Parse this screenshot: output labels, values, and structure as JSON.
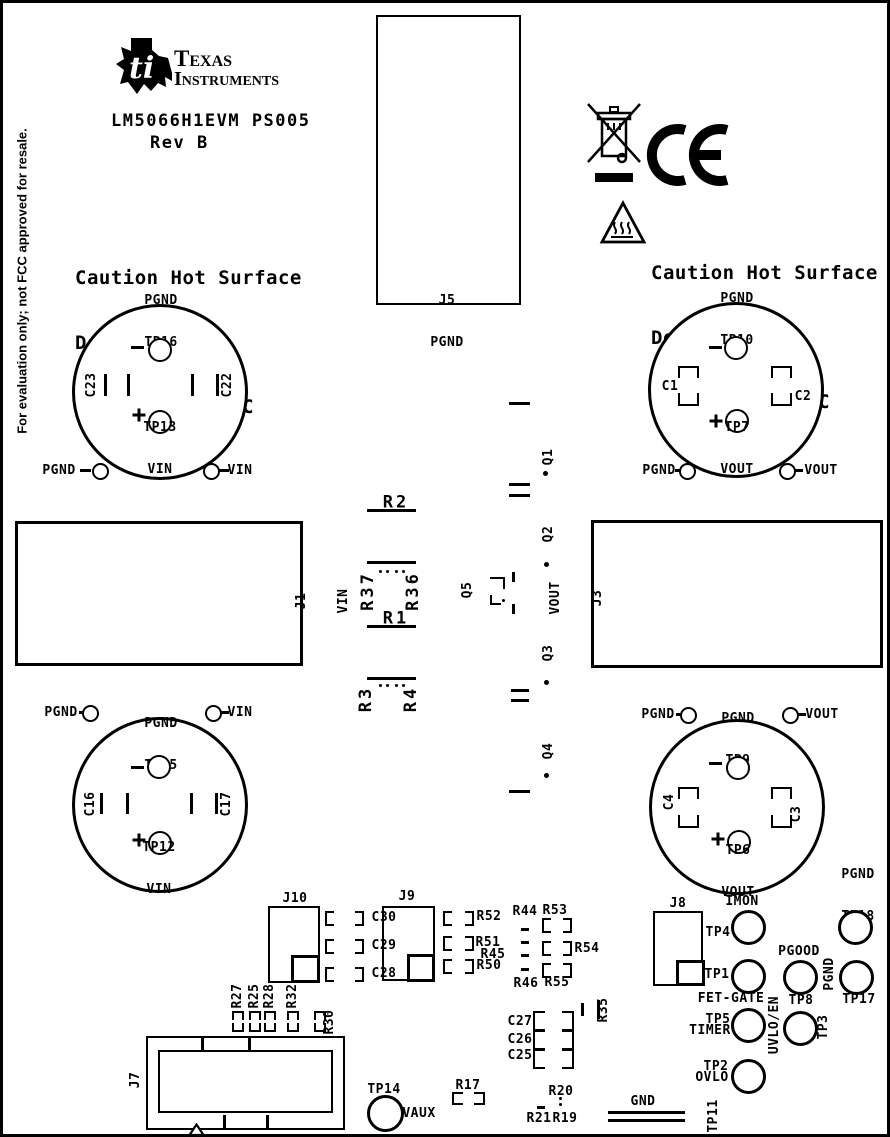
{
  "board": {
    "side_note": "For evaluation only; not FCC approved for resale.",
    "brand": {
      "line1": "Texas",
      "line2": "Instruments",
      "monogram": "ti"
    },
    "title": "LM5066H1EVM PS005",
    "revision": "Rev B",
    "caution": {
      "line1": "Caution Hot Surface",
      "line2": "Do not touch!",
      "line3": "100A Maximum DC"
    },
    "icons": {
      "ti_logo": "texas-instruments-logo",
      "weee": "weee-crossed-out-bin",
      "ce": "ce-marking",
      "hot_surface": "hot-surface-warning-triangle",
      "pin1": "pin1-marker-triangle"
    }
  },
  "connectors": {
    "j1": {
      "ref": "J1",
      "net": "VIN"
    },
    "j3": {
      "net": "VOUT",
      "ref": "J3"
    },
    "j5": {
      "ref": "J5",
      "net": "PGND"
    },
    "j7": {
      "ref": "J7"
    },
    "j8": {
      "ref": "J8"
    },
    "j9": {
      "ref": "J9"
    },
    "j10": {
      "ref": "J10"
    }
  },
  "terminal_circles": {
    "input_top": {
      "top_net": "PGND",
      "top_tp": "TP16",
      "bottom_tp": "TP13",
      "bottom_net": "VIN",
      "cap_left": "C23",
      "cap_right": "C22"
    },
    "output_top": {
      "top_net": "PGND",
      "top_tp": "TP10",
      "bottom_tp": "TP7",
      "bottom_net": "VOUT",
      "cap_left": "C1",
      "cap_right": "C2"
    },
    "input_bottom": {
      "top_net": "PGND",
      "top_tp": "TP15",
      "bottom_tp": "TP12",
      "bottom_net": "VIN",
      "cap_left": "C16",
      "cap_right": "C17"
    },
    "output_bottom": {
      "top_net": "PGND",
      "top_tp": "TP9",
      "bottom_tp": "TP6",
      "bottom_net": "VOUT",
      "cap_left": "C4",
      "cap_right": "C3"
    }
  },
  "pad_rows": {
    "in_top": {
      "left": "PGND",
      "right": "VIN"
    },
    "out_top": {
      "left": "PGND",
      "right": "VOUT"
    },
    "in_bottom": {
      "left": "PGND",
      "right": "VIN"
    },
    "out_bottom": {
      "left": "PGND",
      "right": "VOUT"
    }
  },
  "mid_components": {
    "r2": "R2",
    "r37": "R37",
    "r36": "R36",
    "r1": "R1",
    "r3": "R3",
    "r4": "R4",
    "q1": "Q1",
    "q2": "Q2",
    "q3": "Q3",
    "q4": "Q4",
    "q5": "Q5"
  },
  "bottom_components": {
    "c30": "C30",
    "c29": "C29",
    "c28": "C28",
    "r52": "R52",
    "r51": "R51",
    "r45": "R45",
    "r50": "R50",
    "r44": "R44",
    "r53": "R53",
    "r54": "R54",
    "r46": "R46",
    "r55": "R55",
    "r27": "R27",
    "r25": "R25",
    "r28": "R28",
    "r32": "R32",
    "r30": "R30",
    "r17": "R17",
    "c27": "C27",
    "c26": "C26",
    "c25": "C25",
    "r35": "R35",
    "r20": "R20",
    "r21": "R21",
    "r19": "R19",
    "gnd": "GND"
  },
  "test_points": {
    "tp4": {
      "ref": "TP4",
      "signal": "IMON"
    },
    "tp18": {
      "net": "PGND",
      "ref": "TP18"
    },
    "tp1": {
      "ref": "TP1",
      "signal": "FET-GATE"
    },
    "tp8": {
      "ref": "TP8",
      "signal": "PGOOD"
    },
    "tp17": {
      "net": "PGND",
      "ref": "TP17"
    },
    "tp5": {
      "ref": "TP5",
      "signal": "TIMER"
    },
    "tp3": {
      "ref": "TP3",
      "signal": "UVLO/EN"
    },
    "tp2": {
      "ref": "TP2",
      "signal": "OVLO"
    },
    "tp14": {
      "ref": "TP14",
      "signal": "VAUX"
    },
    "tp11": {
      "ref": "TP11"
    }
  }
}
